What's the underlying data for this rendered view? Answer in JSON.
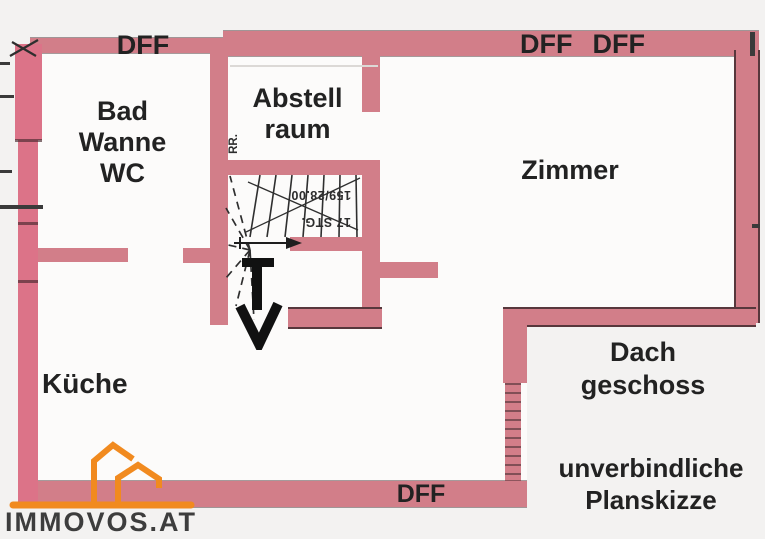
{
  "colors": {
    "wall": "#d27e89",
    "wall_strong": "#dc7388",
    "background": "#f3f2f1",
    "room": "#fcfbfa",
    "ink": "#222222",
    "logo_orange": "#f18a1f",
    "logo_text": "#3d3d3d"
  },
  "roof_windows": {
    "top_left": "DFF",
    "top_right_1": "DFF",
    "top_right_2": "DFF",
    "bottom": "DFF"
  },
  "rooms": {
    "bad": {
      "lines": [
        "Bad",
        "Wanne",
        "WC"
      ]
    },
    "abstellraum": {
      "lines": [
        "Abstell",
        "raum"
      ]
    },
    "zimmer": {
      "label": "Zimmer"
    },
    "kueche": {
      "label": "Küche"
    }
  },
  "floor_label": {
    "lines": [
      "Dach",
      "geschoss"
    ]
  },
  "disclaimer": {
    "lines": [
      "unverbindliche",
      "Planskizze"
    ]
  },
  "stairs": {
    "steps": "17 STG.",
    "dimension": "159/28.00",
    "pipe": "RR."
  },
  "logo": {
    "text": "IMMOVOS.AT"
  }
}
